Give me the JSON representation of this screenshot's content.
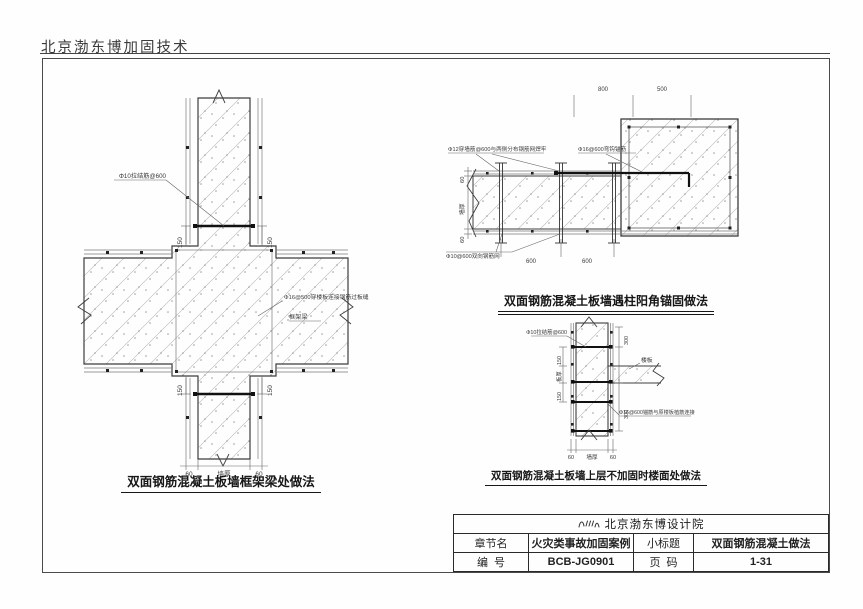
{
  "header": {
    "company": "北京渤东博加固技术"
  },
  "drawing_left": {
    "caption": "双面钢筋混凝土板墙框架梁处做法",
    "label_tie_bar": "Φ10拉结筋@600",
    "label_slab_bar": "Φ16@500穿楼板连接钢筋过板缝",
    "label_frame_beam": "框架梁",
    "dim_150": "150",
    "dim_60": "60",
    "dim_wall_thickness": "墙厚"
  },
  "drawing_corner": {
    "caption": "双面钢筋混凝土板墙遇柱阳角锚固做法",
    "note_through_wall": "Φ12穿墙筋@600与两侧分布钢筋网焊牢",
    "note_hook_anchor": "Φ16@600弯钩锚筋",
    "note_mesh": "Φ10@600双向钢筋网",
    "dim_800": "800",
    "dim_500": "500",
    "dim_600": "600",
    "dim_60": "60",
    "dim_wall_thickness": "墙厚"
  },
  "drawing_floor": {
    "caption": "双面钢筋混凝土板墙上层不加固时楼面处做法",
    "label_tie_bar": "Φ10拉结筋@600",
    "label_slab": "楼板",
    "note_anchor": "Φ16@600锚筋与原楼板植筋连接",
    "dim_150": "150",
    "dim_slab_thickness": "板厚",
    "dim_300": "300",
    "dim_60": "60",
    "dim_wall_thickness": "墙厚"
  },
  "title_block": {
    "institute": "北京渤东博设计院",
    "row_chapter": {
      "label": "章节名",
      "value": "火灾类事故加固案例"
    },
    "row_subtitle": {
      "label": "小标题",
      "value": "双面钢筋混凝土做法"
    },
    "row_number": {
      "label": "编  号",
      "value": "BCB-JG0901"
    },
    "row_page": {
      "label": "页  码",
      "value": "1-31"
    }
  }
}
